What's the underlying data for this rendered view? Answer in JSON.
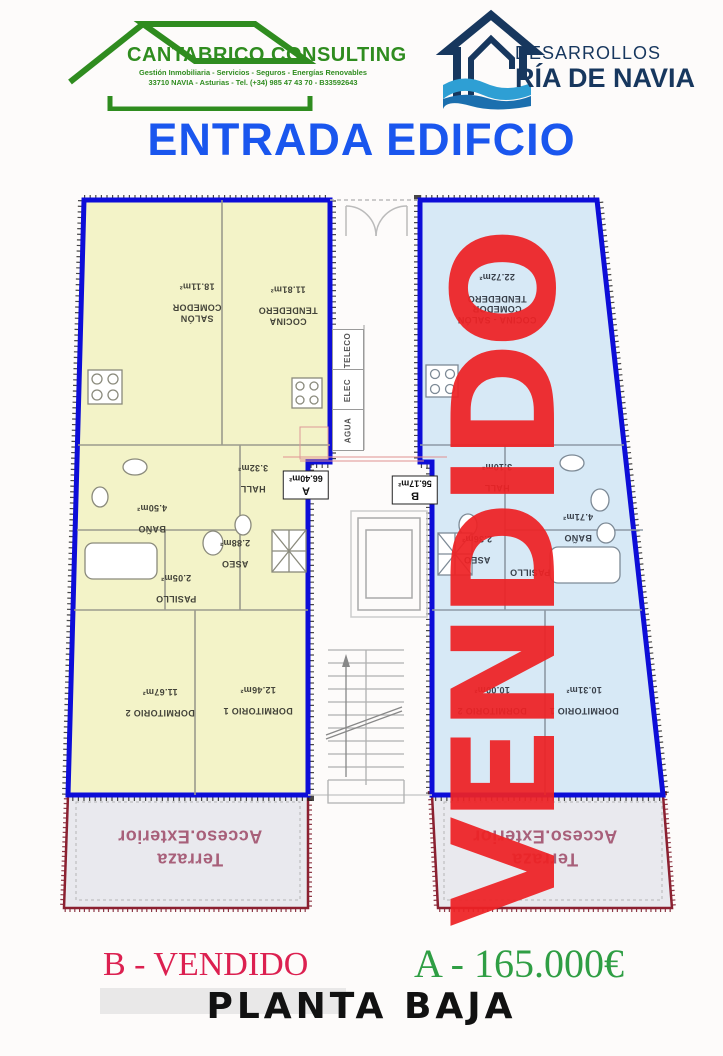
{
  "header": {
    "cantabrico": {
      "name": "CANTABRICO CONSULTING",
      "tagline": "Gestión Inmobiliaria  -  Servicios  -  Seguros  -  Energías Renovables",
      "address": "33710 NAVIA - Asturias - Tel. (+34) 985 47 43 70 - B33592643",
      "color": "#2f8c1f"
    },
    "ria_de_navia": {
      "line1": "DESARROLLOS",
      "line2": "RÍA DE NAVIA",
      "color": "#17375e",
      "wave_color": "#2e9fd4"
    }
  },
  "title": "ENTRADA EDIFCIO",
  "plan": {
    "utilities": [
      "TELECO",
      "ELEC",
      "AGUA"
    ],
    "apartment_a": {
      "badge": {
        "letter": "A",
        "area": "66.40m²"
      },
      "fill": "#f3f3c8",
      "rooms": {
        "salon": {
          "name": "SALÓN\nCOMEDOR",
          "area": "18.11m²"
        },
        "cocina": {
          "name": "COCINA\nTENDEDERO",
          "area": "11.81m²"
        },
        "hall": {
          "name": "HALL",
          "area": "3.32m²"
        },
        "bano": {
          "name": "BAÑO",
          "area": "4.50m²"
        },
        "aseo": {
          "name": "ASEO",
          "area": "2.88m²"
        },
        "pasillo": {
          "name": "PASILLO",
          "area": "2.05m²"
        },
        "dormitorio2": {
          "name": "DORMITORIO 2",
          "area": "11.67m²"
        },
        "dormitorio1": {
          "name": "DORMITORIO 1",
          "area": "12.46m²"
        }
      },
      "terraza": {
        "name": "Terraza\nAcceso.Exterior"
      }
    },
    "apartment_b": {
      "badge": {
        "letter": "B",
        "area": "56.17m²"
      },
      "fill": "#d7e9f6",
      "overlay": "VENDIDO",
      "rooms": {
        "cocina_salon": {
          "name": "COCINA - SALÓN\nCOMEDOR\nTENDEDERO",
          "area": "22.72m²"
        },
        "hall": {
          "name": "HALL",
          "area": "3.10m²"
        },
        "bano": {
          "name": "BAÑO",
          "area": "4.71m²"
        },
        "aseo": {
          "name": "ASEO",
          "area": "2.36m²"
        },
        "pasillo": {
          "name": "PASILLO",
          "area": ""
        },
        "dormitorio2": {
          "name": "DORMITORIO 2",
          "area": "10.00m²"
        },
        "dormitorio1": {
          "name": "DORMITORIO 1",
          "area": "10.31m²"
        }
      },
      "terraza": {
        "name": "Terraza\nAcceso.Exterior"
      }
    }
  },
  "footer": {
    "b_status": "B - VENDIDO",
    "a_price": "A - 165.000€",
    "floor_label": "PLANTA BAJA"
  },
  "colors": {
    "title_blue": "#1a56ee",
    "wall_blue": "#0d0dd8",
    "vendido_red": "#ee2225",
    "terraza_border": "#8b2030",
    "terraza_text": "#a8607a",
    "b_status_color": "#dc2050",
    "a_price_color": "#2f9e44"
  }
}
